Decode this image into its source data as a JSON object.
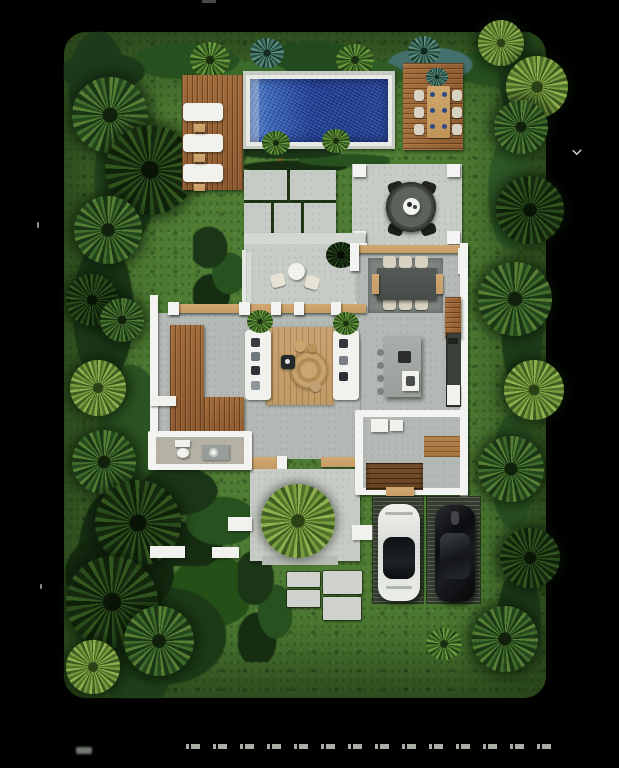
{
  "scene": {
    "kind": "top-down 3D rendering of a villa site plan on black background",
    "labels": {
      "site": "Tropical garden plot with lawn and palm trees",
      "pool": "Rectangular swimming pool with mosaic water",
      "lounger_deck": "Timber sun deck with three white loungers",
      "dining_deck": "Timber deck with outdoor dining table for six",
      "patio": "Concrete patio with round table and four chairs",
      "terrace": "Entry terrace with bistro table, two chairs and a plant",
      "dining_room": "Indoor dining area, table with six chairs on gray rug",
      "living_room": "Living area, two facing sofas on wooden rug",
      "kitchen": "Kitchen island with stools and wall counter",
      "bathroom": "Bathroom with toilet and vanity",
      "stair_room": "Utility room with timber staircase",
      "carport": "Slatted carport pads with two parked cars",
      "big_plant": "Large round palm shrub on concrete pad",
      "stepping_stones": "Concrete stepping stone path"
    }
  },
  "counts": {
    "loungers": 3,
    "outdoor_dining_chairs": 6,
    "patio_chairs": 4,
    "terrace_chairs": 2,
    "indoor_dining_chairs": 6,
    "kitchen_stools": 4,
    "sofas": 2,
    "cars": 2,
    "stepping_stones": 4,
    "pad_columns": 4
  },
  "vehicles": [
    {
      "slot": "left",
      "body": "white convertible",
      "color": "#e9eae6"
    },
    {
      "slot": "right",
      "body": "black coupe",
      "color": "#101114"
    }
  ],
  "footer": {
    "fine_print_legible": false,
    "note_marks": "row of tiny unreadable white text on black margin"
  },
  "colors": {
    "lawn": "#4e7c33",
    "foliage_dark": "#1c3318",
    "foliage_mid": "#2f5526",
    "foliage_light": "#6f9b48",
    "pool_deep": "#1f3e94",
    "pool_light": "#5b8ad0",
    "coping": "#e8eae5",
    "wood": "#9a6739",
    "wood_light": "#c69b64",
    "concrete": "#c8ccc7",
    "concrete_indoor": "#b4b9b6",
    "wall": "#f3f4f1",
    "rug_gray": "#7f8480",
    "rug_wood": "#c19b66",
    "charcoal": "#2b2e2b",
    "carport": "#353b31",
    "car_white": "#e9eae6",
    "car_black": "#101114"
  }
}
